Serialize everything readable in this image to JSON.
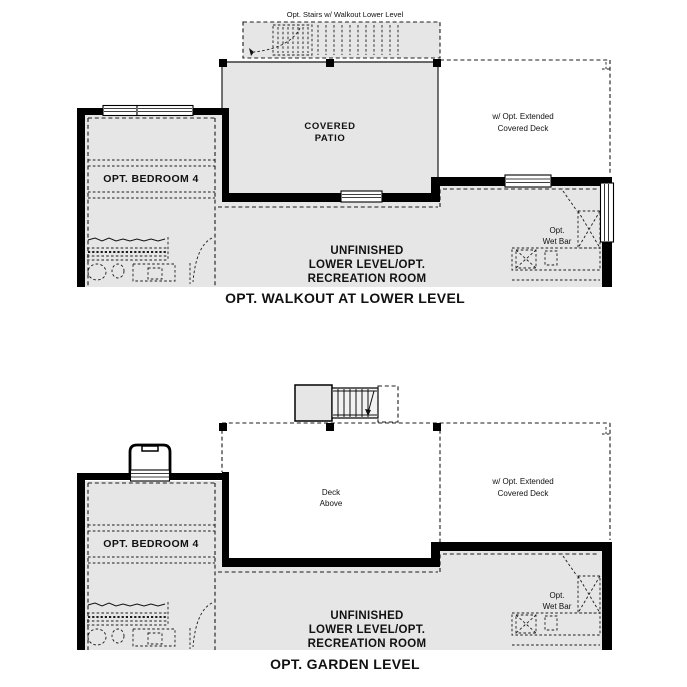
{
  "colors": {
    "floor_fill": "#e6e6e6",
    "wall": "#000000",
    "line": "#1c1c1c",
    "background": "#ffffff"
  },
  "plans": {
    "walkout": {
      "caption": "OPT. WALKOUT AT LOWER LEVEL",
      "stairs_label": "Opt. Stairs w/ Walkout Lower Level",
      "patio_line1": "COVERED",
      "patio_line2": "PATIO",
      "deck_line1": "w/ Opt. Extended",
      "deck_line2": "Covered Deck",
      "bedroom_label": "OPT. BEDROOM 4",
      "room_line1": "UNFINISHED",
      "room_line2": "LOWER LEVEL/OPT.",
      "room_line3": "RECREATION ROOM",
      "wetbar_line1": "Opt.",
      "wetbar_line2": "Wet Bar"
    },
    "garden": {
      "caption": "OPT. GARDEN LEVEL",
      "deck_above_line1": "Deck",
      "deck_above_line2": "Above",
      "deck_line1": "w/ Opt. Extended",
      "deck_line2": "Covered Deck",
      "bedroom_label": "OPT. BEDROOM 4",
      "room_line1": "UNFINISHED",
      "room_line2": "LOWER LEVEL/OPT.",
      "room_line3": "RECREATION ROOM",
      "wetbar_line1": "Opt.",
      "wetbar_line2": "Wet Bar"
    }
  }
}
